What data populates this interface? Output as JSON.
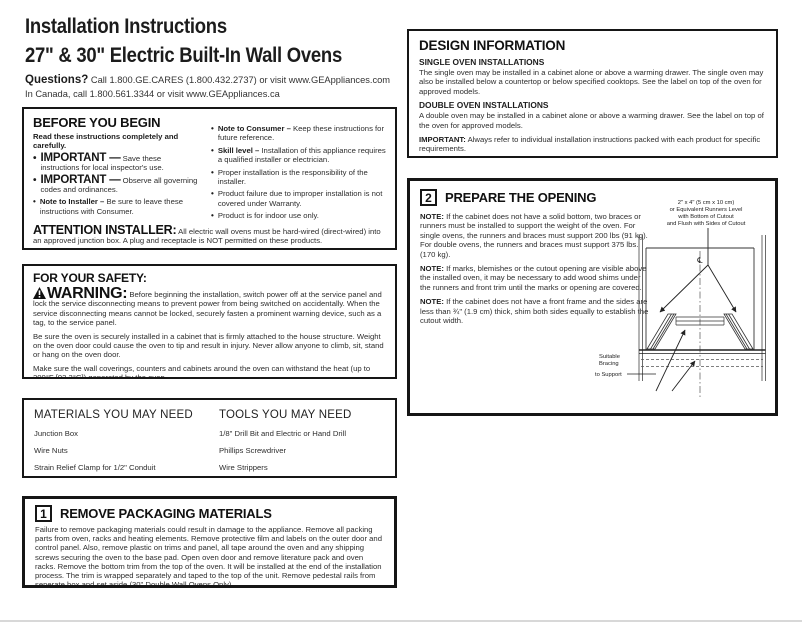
{
  "header": {
    "title_line1": "Installation Instructions",
    "title_line2": "27\" & 30\" Electric Built-In Wall Ovens",
    "questions_label": "Questions?",
    "questions_text": "Call 1.800.GE.CARES (1.800.432.2737) or visit www.GEAppliances.com",
    "canada_text": "In Canada, call 1.800.561.3344 or visit www.GEAppliances.ca"
  },
  "before_you_begin": {
    "heading": "BEFORE YOU BEGIN",
    "intro": "Read these instructions completely and carefully.",
    "left_bullets": [
      {
        "lead": "IMPORTANT —",
        "text": "Save these instructions for local inspector's use."
      },
      {
        "lead": "IMPORTANT —",
        "text": "Observe all governing codes and ordinances."
      },
      {
        "lead": "Note to Installer –",
        "text": "Be sure to leave these instructions with Consumer."
      }
    ],
    "right_bullets": [
      {
        "lead": "Note to Consumer –",
        "text": "Keep these instructions for future reference."
      },
      {
        "lead": "Skill level –",
        "text": "Installation of this appliance requires a qualified installer or electrician."
      },
      {
        "lead": "",
        "text": "Proper installation is the responsibility of the installer."
      },
      {
        "lead": "",
        "text": "Product failure due to improper installation is not covered under Warranty."
      },
      {
        "lead": "",
        "text": "Product is for indoor use only."
      }
    ],
    "attention_lead": "ATTENTION INSTALLER:",
    "attention_text": "All electric wall ovens must be hard-wired (direct-wired) into an approved junction box. A plug and receptacle is NOT permitted on these products."
  },
  "safety": {
    "heading": "FOR YOUR SAFETY:",
    "warning_label": "WARNING:",
    "warning_text": "Before beginning the installation, switch power off at the service panel and lock the service disconnecting means to prevent power from being switched on accidentally. When the service disconnecting means cannot be locked, securely fasten a prominent warning device, such as a tag, to the service panel.",
    "para2": "Be sure the oven is securely installed in a cabinet that is firmly attached to the house structure. Weight on the oven door could cause the oven to tip and result in injury. Never allow anyone to climb, sit, stand or hang on the oven door.",
    "para3": "Make sure the wall coverings, counters and cabinets around the oven can withstand the heat (up to 200°F [93.3°C]) generated by the oven."
  },
  "materials": {
    "heading": "MATERIALS YOU MAY NEED",
    "items": [
      "Junction Box",
      "Wire Nuts",
      "Strain Relief Clamp for 1/2\" Conduit"
    ]
  },
  "tools": {
    "heading": "TOOLS YOU MAY NEED",
    "items": [
      "1/8\" Drill Bit and Electric or Hand Drill",
      "Phillips Screwdriver",
      "Wire Strippers"
    ]
  },
  "step1": {
    "number": "1",
    "heading": "REMOVE PACKAGING MATERIALS",
    "body": "Failure to remove packaging materials could result in damage to the appliance. Remove all packing parts from oven, racks and heating elements. Remove protective film and labels on the outer door and control panel. Also, remove plastic on trims and panel, all tape around the oven and any shipping screws securing the oven to the base pad. Open oven door and remove literature pack and oven racks. Remove the bottom trim from the top of the oven. It will be installed at the end of the installation process. The trim is wrapped separately and taped to the top of the unit. Remove pedestal rails from seperate box and set aside (30\" Double Wall Ovens Only)."
  },
  "design_info": {
    "heading": "DESIGN INFORMATION",
    "single_heading": "SINGLE OVEN INSTALLATIONS",
    "single_text": "The single oven may be installed in a cabinet alone or above a warming drawer. The single oven may also be installed below a countertop or below specified cooktops. See the label on top of the oven for approved models.",
    "double_heading": "DOUBLE OVEN INSTALLATIONS",
    "double_text": "A double oven may be installed in a cabinet alone or above a warming drawer. See the label on top of the oven for approved models.",
    "important_lead": "IMPORTANT:",
    "important_text": "Always refer to individual installation instructions packed with each product for specific requirements."
  },
  "step2": {
    "number": "2",
    "heading": "PREPARE THE OPENING",
    "notes": [
      {
        "lead": "NOTE:",
        "text": "If the cabinet does not have a solid bottom, two braces or runners must be installed to support the weight of the oven. For single ovens, the runners and braces must support 200 lbs (91 kg). For double ovens, the runners and braces must support 375 lbs. (170 kg)."
      },
      {
        "lead": "NOTE:",
        "text": "If marks, blemishes or the cutout opening are visible above the installed oven, it may be necessary to add wood shims under the runners and front trim until the marks or opening are covered."
      },
      {
        "lead": "NOTE:",
        "text": "If the cabinet does not have a front frame and the sides are less than ¾\" (1.9 cm) thick, shim both sides equally to establish the cutout width."
      }
    ],
    "diagram": {
      "runner_label_line1": "2\" x 4\" (5 cm x 10 cm)",
      "runner_label_line2": "or Equivalent Runners Level",
      "runner_label_line3": "with Bottom of Cutout",
      "runner_label_line4": "and Flush with Sides of Cutout",
      "bracing_label_line1": "Suitable",
      "bracing_label_line2": "Bracing",
      "bracing_label_line3": "to Support",
      "centerline_symbol": "℄"
    }
  }
}
